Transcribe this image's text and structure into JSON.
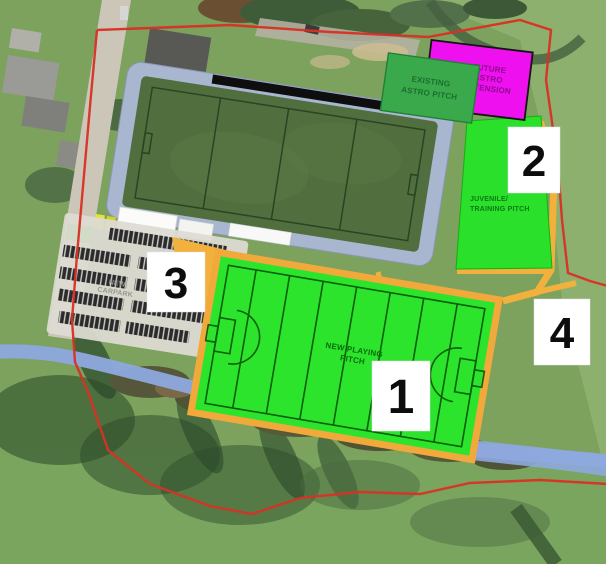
{
  "title": "Aerial site plan — GAA grounds development with annotated pitches",
  "colors": {
    "boundary_red": "#d93025",
    "stream_blue": "#8ea9de",
    "bright_pitch_green": "#2be42b",
    "astro_green": "#3aa94c",
    "future_magenta": "#ee10ee",
    "path_orange": "#f2b13c",
    "walkway_grey": "#a9b6d0",
    "marker_bg": "#ffffff"
  },
  "map": {
    "labels": {
      "existing_astro": [
        "EXISTING",
        "ASTRO PITCH"
      ],
      "future_astro": [
        "FUTURE",
        "ASTRO",
        "EXTENSION"
      ],
      "juvenile_pitch": [
        "JUVENILE/",
        "TRAINING PITCH"
      ],
      "new_pitch": [
        "NEW PLAYING",
        "PITCH"
      ],
      "carpark": [
        "NEW",
        "CARPARK"
      ]
    },
    "markers": [
      "1",
      "2",
      "3",
      "4"
    ]
  }
}
